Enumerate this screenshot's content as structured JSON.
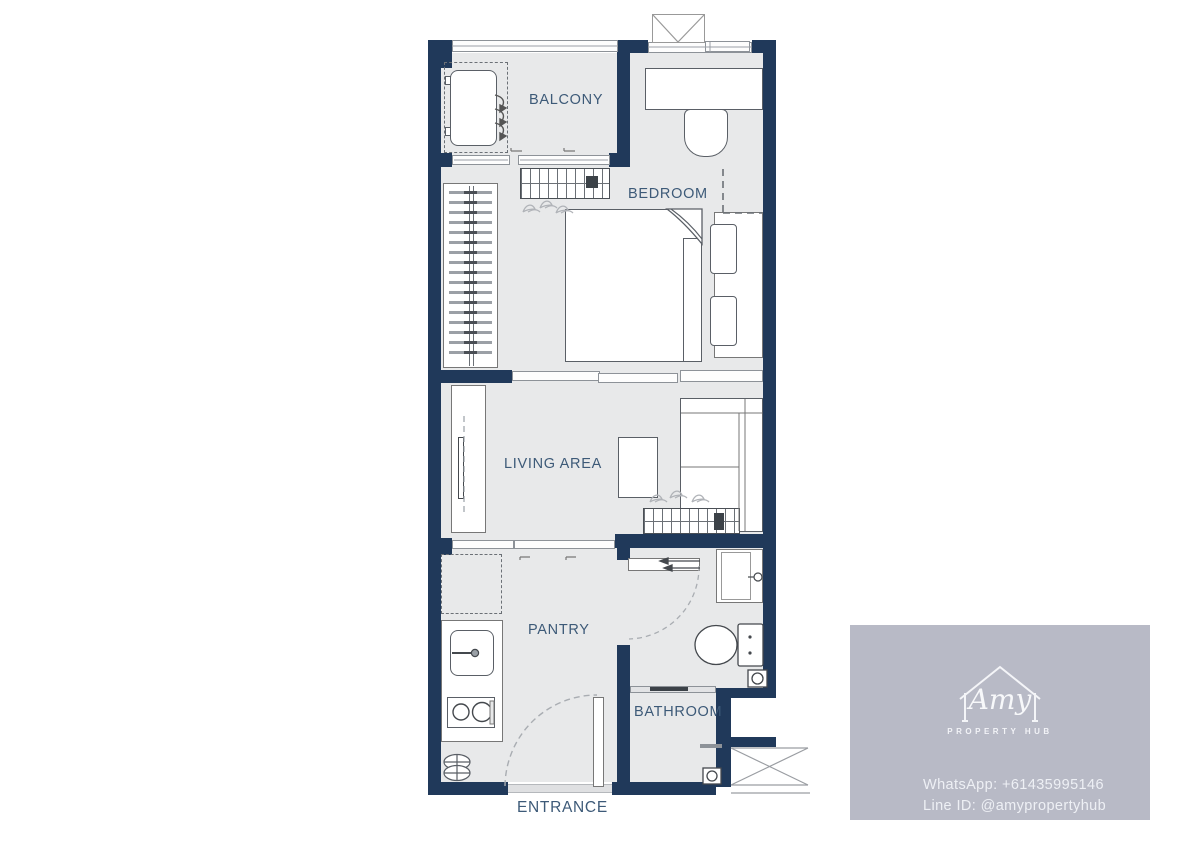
{
  "floorplan": {
    "labels": {
      "balcony": "BALCONY",
      "bedroom": "BEDROOM",
      "living": "LIVING AREA",
      "pantry": "PANTRY",
      "bathroom": "BATHROOM",
      "entrance": "ENTRANCE"
    },
    "furniture_symbols": [
      "ac-condenser",
      "sliding-door",
      "ac-louver-unit",
      "wardrobe-hangers",
      "desk",
      "desk-chair",
      "double-bed",
      "pillows",
      "headboard",
      "tv-console",
      "tv",
      "coffee-table",
      "sofa",
      "kitchen-counter",
      "kitchen-sink",
      "stove-two-burners",
      "overhead-cabinet-dashed",
      "entrance-door-swing",
      "bathroom-door-swing",
      "vanity-sink",
      "toilet",
      "floor-drain",
      "shower-screen",
      "service-shaft",
      "window-shaft"
    ]
  },
  "watermark": {
    "brand_script": "Amy",
    "brand_subtitle": "PROPERTY HUB",
    "whatsapp": "WhatsApp: +61435995146",
    "line_id": "Line ID: @amypropertyhub"
  },
  "colors": {
    "wall": "#20395a",
    "floor": "#e8e9ea",
    "furniture_line": "#5a5f66",
    "label_text": "#3d5a78",
    "watermark_bg": "#b8bac6",
    "watermark_text": "#eef0f5"
  }
}
